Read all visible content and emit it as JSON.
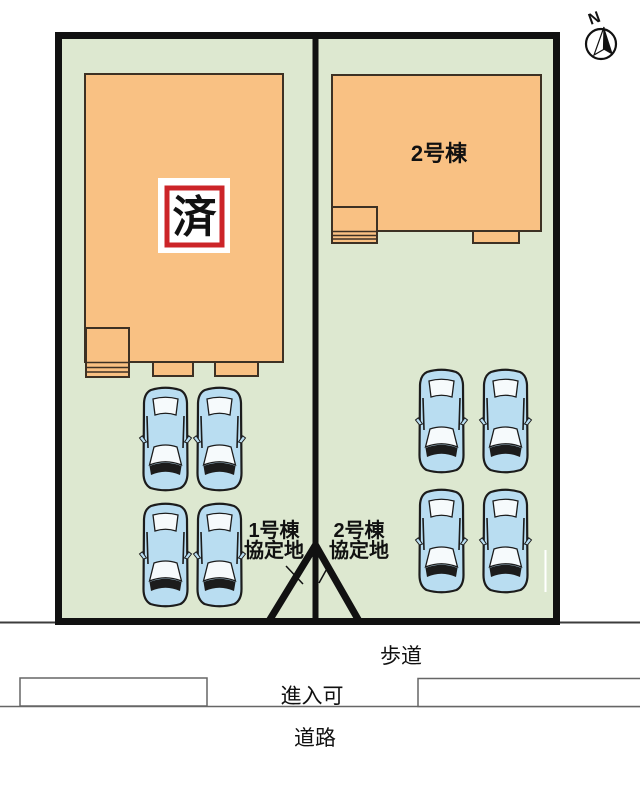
{
  "compass": {
    "north_label": "N"
  },
  "site": {
    "building2_label": "2号棟",
    "sold_stamp_label": "済",
    "covenant_left": {
      "line1": "1号棟",
      "line2": "協定地"
    },
    "covenant_right": {
      "line1": "2号棟",
      "line2": "協定地"
    }
  },
  "road": {
    "sidewalk_label": "歩道",
    "entry_label": "進入可",
    "road_label": "道路"
  },
  "colors": {
    "ground_green": "#dde8d0",
    "building_orange": "#f9c183",
    "building_outline": "#3d3124",
    "stamp_red": "#cc2428",
    "car_blue": "#b9ddf1",
    "boundary_black": "#111111"
  }
}
